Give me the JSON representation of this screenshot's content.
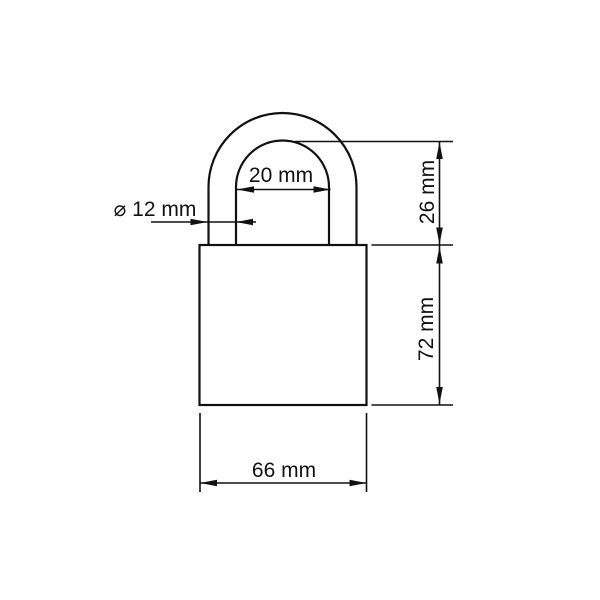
{
  "diagram": {
    "background_color": "#ffffff",
    "line_color": "#111111",
    "labels": {
      "shackle_inner_width": "20 mm",
      "shackle_diameter": "⌀ 12 mm",
      "shackle_height": "26 mm",
      "body_height": "72 mm",
      "body_width": "66 mm"
    }
  }
}
